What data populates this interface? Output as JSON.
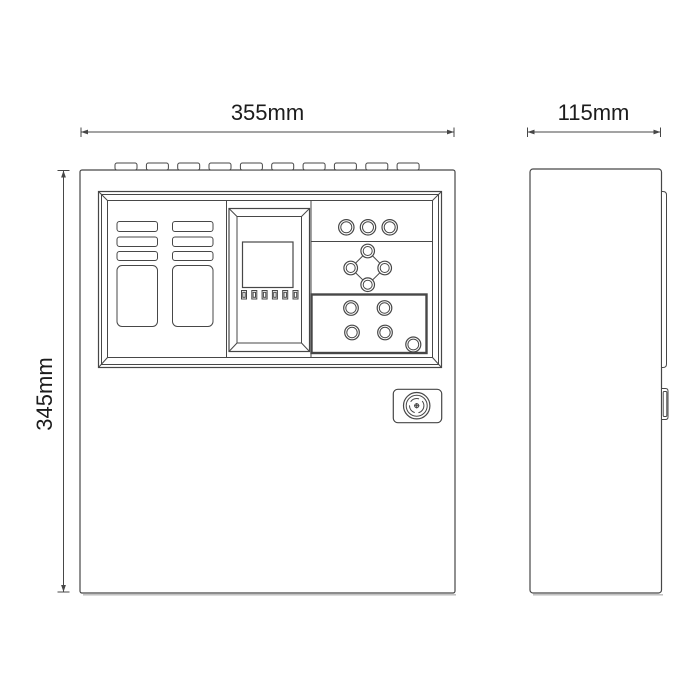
{
  "colors": {
    "background": "#ffffff",
    "line": "#474747",
    "shadow": "#b9b9b9",
    "text": "#1c1c1c"
  },
  "labels": {
    "front_width": "355mm",
    "front_height": "345mm",
    "side_depth": "115mm"
  }
}
